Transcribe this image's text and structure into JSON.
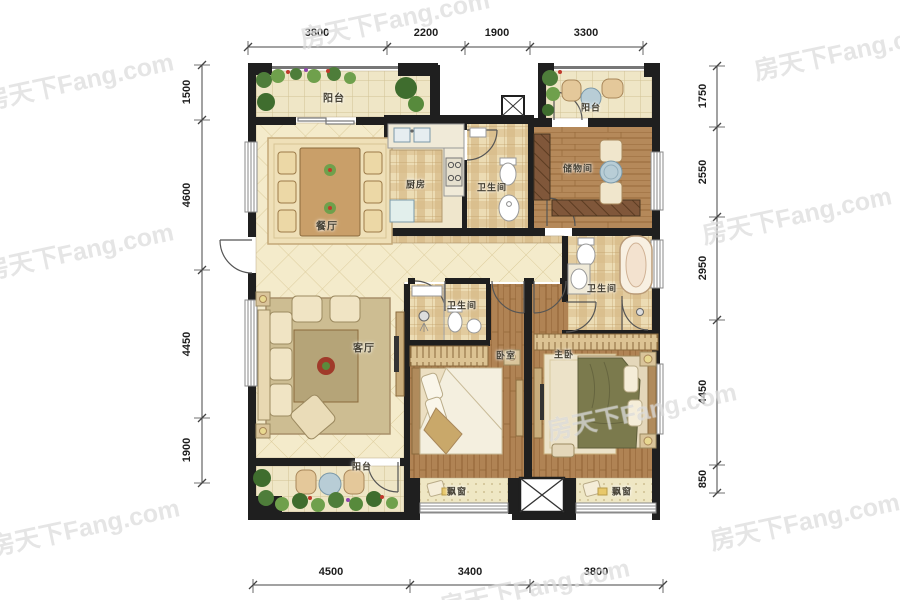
{
  "watermark": {
    "text": "房天下Fang.com"
  },
  "dimensions": {
    "top": [
      "3800",
      "2200",
      "1900",
      "3300"
    ],
    "left": [
      "1500",
      "4600",
      "4450",
      "1900"
    ],
    "right": [
      "1750",
      "2550",
      "2950",
      "4450",
      "850"
    ],
    "bottom": [
      "4500",
      "3400",
      "3800"
    ]
  },
  "rooms": {
    "balcony_tl": {
      "label": "阳台"
    },
    "dining": {
      "label": "餐厅"
    },
    "kitchen": {
      "label": "厨房"
    },
    "bath_top": {
      "label": "卫生间"
    },
    "storage": {
      "label": "储物间"
    },
    "balcony_tr": {
      "label": "阳台"
    },
    "bath_right": {
      "label": "卫生间"
    },
    "living": {
      "label": "客厅"
    },
    "bath_mid": {
      "label": "卫生间"
    },
    "bedroom": {
      "label": "卧室"
    },
    "master_bedroom": {
      "label": "主卧"
    },
    "balcony_bl": {
      "label": "阳台"
    },
    "bay_window_left": {
      "label": "飘窗"
    },
    "bay_window_right": {
      "label": "飘窗"
    }
  },
  "colors": {
    "wall": "#1f1f1f",
    "floor_tile": "#f2e9cb",
    "wood_floor": "#b5895a",
    "plaid_floor": "#e6d4ab",
    "plant_green": "#4e7d3a",
    "watermark_gray": "#c3c3c3"
  }
}
